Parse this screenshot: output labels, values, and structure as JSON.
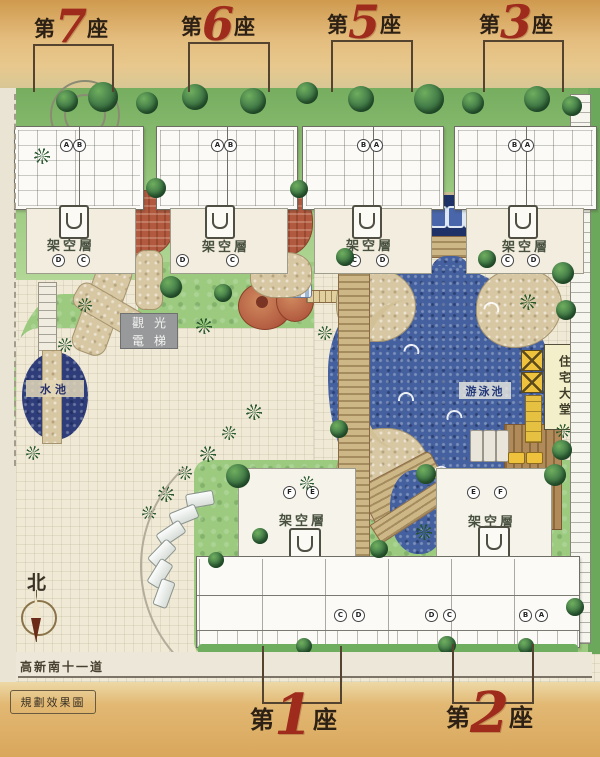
{
  "blocks_top": [
    {
      "prefix": "第",
      "number": "7",
      "suffix": "座"
    },
    {
      "prefix": "第",
      "number": "6",
      "suffix": "座"
    },
    {
      "prefix": "第",
      "number": "5",
      "suffix": "座"
    },
    {
      "prefix": "第",
      "number": "3",
      "suffix": "座"
    }
  ],
  "blocks_bottom": [
    {
      "prefix": "第",
      "number": "1",
      "suffix": "座"
    },
    {
      "prefix": "第",
      "number": "2",
      "suffix": "座"
    }
  ],
  "labels": {
    "stilt_floor": "架空層",
    "elevator_line1": "觀光",
    "elevator_line2": "電梯",
    "pond": "水池",
    "swimming_pool": "游泳池",
    "lobby": "住宅大堂",
    "north": "北",
    "road": "高新南十一道",
    "caption": "規劃效果圖"
  },
  "units": {
    "top": [
      [
        "A",
        "B"
      ],
      [
        "A",
        "B"
      ],
      [
        "B",
        "A"
      ],
      [
        "B",
        "A"
      ]
    ],
    "court": [
      [
        "D",
        "C"
      ],
      [
        "D",
        "C"
      ],
      [
        "C",
        "D"
      ],
      [
        "C",
        "D"
      ]
    ],
    "lower_court": [
      [
        "F",
        "E"
      ],
      [
        "E",
        "F"
      ]
    ],
    "bottom": [
      [
        "C",
        "D"
      ],
      [
        "D",
        "C"
      ],
      [
        "B",
        "A"
      ]
    ]
  },
  "colors": {
    "accent_red": "#9e2b1c",
    "tan_band": "#dfb069",
    "pool_blue": "#44609e",
    "grass_green": "#8cc173",
    "stone_tan": "#d5c49e",
    "terracotta": "#b25a40",
    "elevator_grey": "#97999b",
    "lobby_cream": "#f3efcb",
    "highlight_yellow": "#eec23c"
  }
}
